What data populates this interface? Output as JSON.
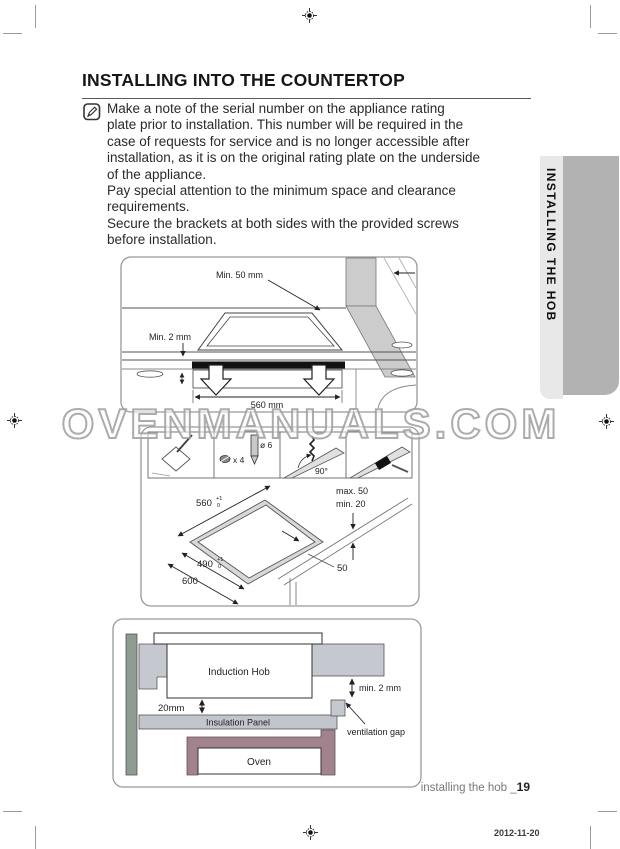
{
  "document": {
    "title": "INSTALLING INTO THE COUNTERTOP",
    "note": "Make a note of the serial number on the appliance rating\nplate prior to installation. This number will be required in the\ncase of requests for service and is no longer accessible after\ninstallation, as it is on the original rating plate on the underside\nof the appliance.\nPay special attention to the minimum space and clearance\nrequirements.\nSecure the brackets at both sides with the provided screws\nbefore installation.",
    "side_tab": "INSTALLING THE HOB",
    "watermark": "OVENMANUALS.COM",
    "footer": {
      "label": "installing the hob _",
      "page": "19",
      "date": "2012-11-20"
    }
  },
  "diagram_clearance": {
    "min_wall": "Min. 50 mm",
    "min_gap": "Min. 2 mm",
    "width": "560 mm"
  },
  "diagram_cutout": {
    "screws_qty": "x 4",
    "drill_dia": "ø 6",
    "angle": "90°",
    "cut_width": "560",
    "cut_depth": "490",
    "counter_depth": "600",
    "front_distance": "50",
    "tol_plus": "+1",
    "tol_zero": "0",
    "edge_max": "max. 50",
    "edge_min": "min. 20"
  },
  "diagram_section": {
    "hob": "Induction Hob",
    "gap_size": "min. 2 mm",
    "clearance": "20mm",
    "insulation": "Insulation Panel",
    "vent_label": "ventilation gap",
    "oven": "Oven"
  },
  "colors": {
    "wall": "#cccccc",
    "counter_block": "#c6c8d0",
    "cabinet_side": "#8e9b91",
    "insulation": "#c3c5cd",
    "oven_frame": "#a2838d",
    "hob_strip": "#111111",
    "tab_light": "#e8e8e8",
    "tab_dark": "#b2b2b2"
  }
}
